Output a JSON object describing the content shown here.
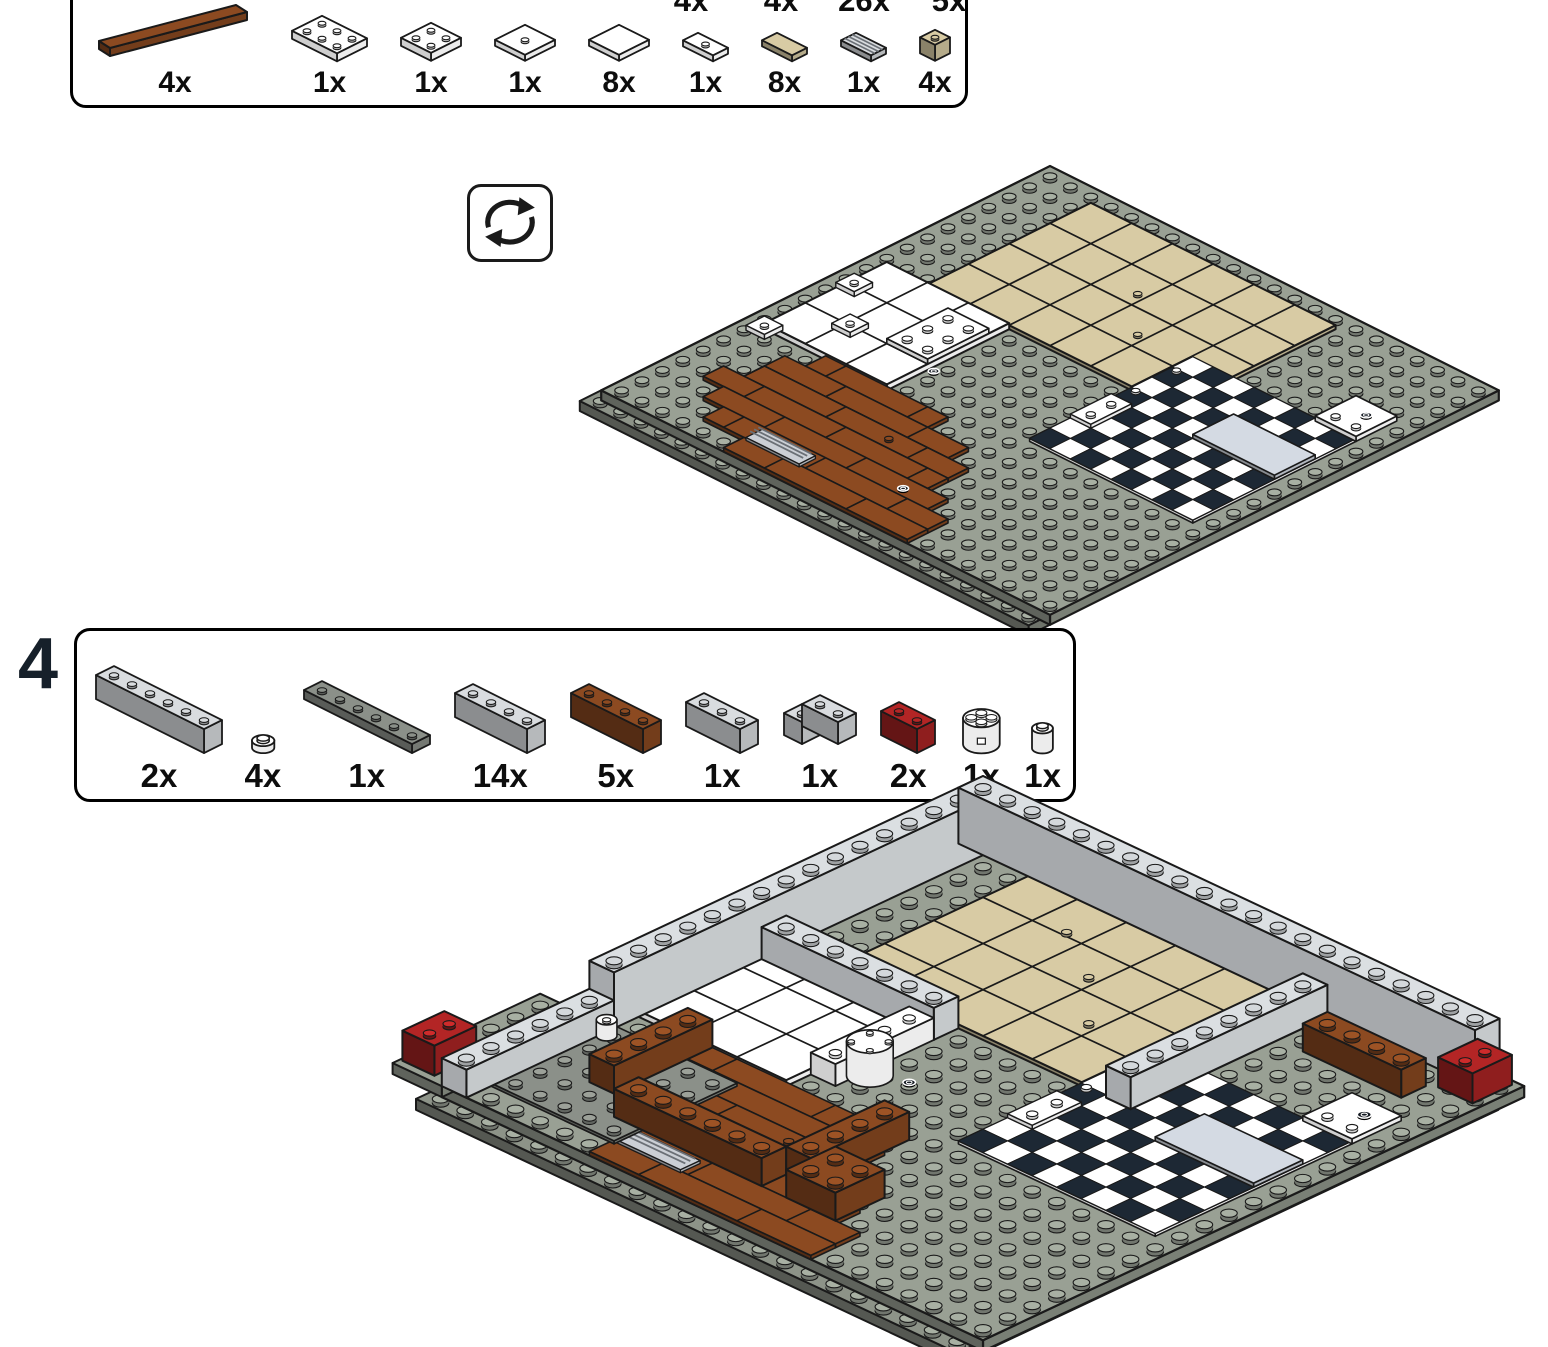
{
  "page": {
    "background": "#ffffff",
    "kind": "building-instruction-page"
  },
  "inventory_box_previous": {
    "cutoff_quantity_labels": [
      "4x",
      "4x",
      "26x",
      "5x"
    ],
    "items": [
      {
        "qty": "4x",
        "part": "tile-1x6-diag",
        "color": "brown"
      },
      {
        "qty": "1x",
        "part": "plate-2x3",
        "color": "white"
      },
      {
        "qty": "1x",
        "part": "plate-2x2",
        "color": "white"
      },
      {
        "qty": "1x",
        "part": "plate-2x2-stud",
        "color": "white"
      },
      {
        "qty": "8x",
        "part": "tile-2x2",
        "color": "white"
      },
      {
        "qty": "1x",
        "part": "jumper-1x2",
        "color": "white"
      },
      {
        "qty": "8x",
        "part": "tile-1x2",
        "color": "tan"
      },
      {
        "qty": "1x",
        "part": "grille-1x2",
        "color": "light-gray"
      },
      {
        "qty": "4x",
        "part": "brick-1x1",
        "color": "tan"
      }
    ]
  },
  "rotate_symbol": {
    "icon": "rotate-view-icon"
  },
  "step4": {
    "step_number": "4",
    "items": [
      {
        "qty": "2x",
        "part": "brick-1x6",
        "color": "light-gray"
      },
      {
        "qty": "4x",
        "part": "round-plate-1x1",
        "color": "white"
      },
      {
        "qty": "1x",
        "part": "plate-1x6",
        "color": "dark-gray"
      },
      {
        "qty": "14x",
        "part": "brick-1x4",
        "color": "light-gray"
      },
      {
        "qty": "5x",
        "part": "brick-1x4-brown",
        "color": "brown"
      },
      {
        "qty": "1x",
        "part": "brick-1x3",
        "color": "light-gray"
      },
      {
        "qty": "1x",
        "part": "corner-2x2",
        "color": "light-gray"
      },
      {
        "qty": "2x",
        "part": "brick-1x2",
        "color": "dark-red"
      },
      {
        "qty": "1x",
        "part": "round-2x2",
        "color": "white"
      },
      {
        "qty": "1x",
        "part": "round-1x1",
        "color": "white"
      }
    ]
  },
  "palette": {
    "baseplate_gray": "#99A094",
    "baseplate_gray_under": "#8D9388",
    "tan": "#D8CBA4",
    "white": "#FFFFFF",
    "checker_dark": "#1D2834",
    "wood_brown": "#8C4A21",
    "wall_light_gray": "#DBDFE2",
    "light_gray": "#D9DCDF",
    "dark_gray": "#8B9089",
    "dark_red": "#B32525",
    "blue_gray": "#D4DAE3",
    "grille_gray": "#CBCFD5",
    "outline": "#1A1A1A"
  }
}
